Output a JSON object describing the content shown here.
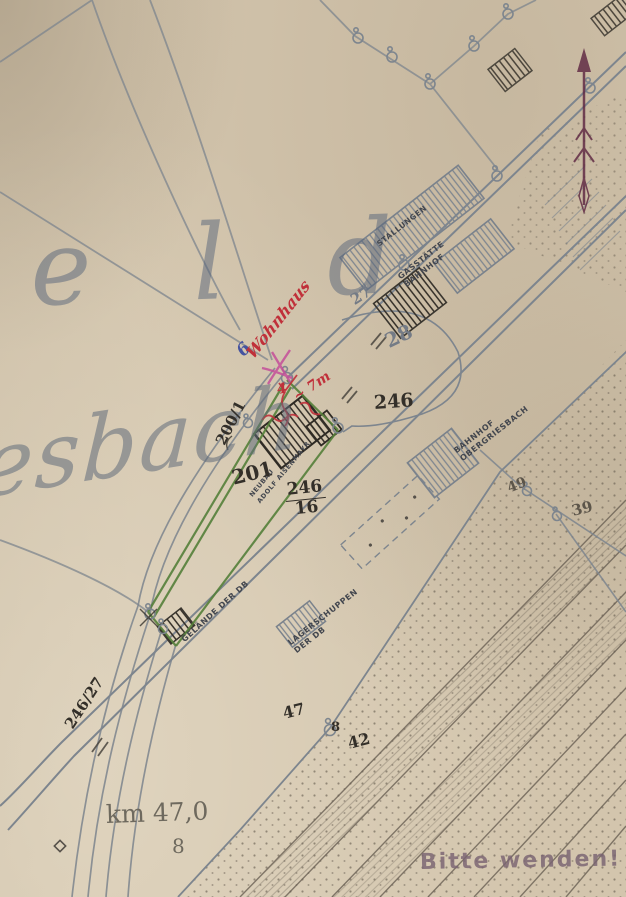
{
  "map_title": {
    "field_name_fragment": "e l d",
    "place_name_fragment": "esbach"
  },
  "station_labels": {
    "stallungen": "STALLUNGEN",
    "gaststaette_line1": "GASSTÄTTE",
    "gaststaette_line2": "BAHNHOF",
    "bahnhof_line1": "BAHNHOF",
    "bahnhof_line2": "OBERGRIESBACH",
    "lagerschuppen_line1": "LAGERSCHUPPEN",
    "lagerschuppen_line2": "DER DB",
    "gelaende": "GELÄNDE DER DB",
    "neubau_line1": "NEUBAU",
    "neubau_line2": "ADOLF AISENMAYR"
  },
  "parcel_numbers": {
    "p200_1": "200/1",
    "p201": "201",
    "p246": "246",
    "p246_16_numerator": "246",
    "p246_16_denominator": "16",
    "p246_27": "246/27",
    "p27": "27",
    "p28": "28",
    "p47": "47",
    "p8": "8",
    "p42": "42",
    "p49": "49",
    "p39": "39"
  },
  "annotations": {
    "blue_number": "6",
    "red_script": "Wohnhaus",
    "red_measurement": "~ 7m",
    "red_number": "4"
  },
  "railway": {
    "km_marker": "km 47,0",
    "km_sub": "8"
  },
  "stamp": {
    "text": "Bitte wenden!"
  },
  "colors": {
    "paper": "#d3c5ad",
    "map_ink": "#7d858e",
    "dark_ink": "#37332c",
    "red": "#c0303a",
    "magenta": "#c44f9a",
    "blue": "#4553a0",
    "green": "#55803a",
    "stamp_purple": "#7a6472",
    "arrow_maroon": "#5e2742"
  }
}
